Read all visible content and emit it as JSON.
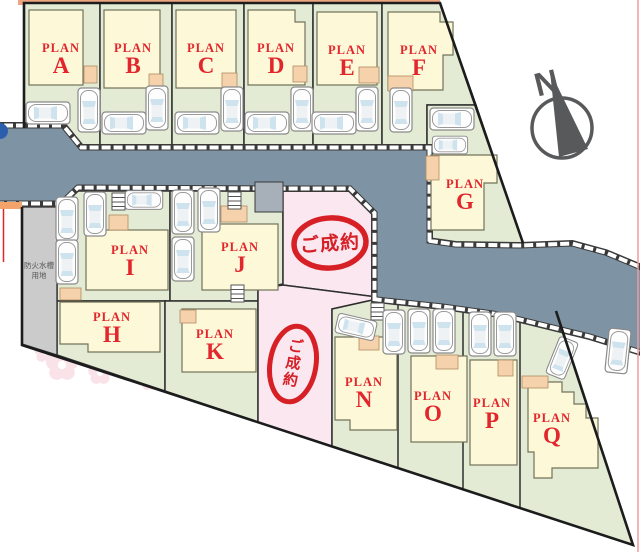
{
  "plans": {
    "a": {
      "prefix": "PLAN",
      "letter": "A"
    },
    "b": {
      "prefix": "PLAN",
      "letter": "B"
    },
    "c": {
      "prefix": "PLAN",
      "letter": "C"
    },
    "d": {
      "prefix": "PLAN",
      "letter": "D"
    },
    "e": {
      "prefix": "PLAN",
      "letter": "E"
    },
    "f": {
      "prefix": "PLAN",
      "letter": "F"
    },
    "g": {
      "prefix": "PLAN",
      "letter": "G"
    },
    "h": {
      "prefix": "PLAN",
      "letter": "H"
    },
    "i": {
      "prefix": "PLAN",
      "letter": "I"
    },
    "j": {
      "prefix": "PLAN",
      "letter": "J"
    },
    "k": {
      "prefix": "PLAN",
      "letter": "K"
    },
    "n": {
      "prefix": "PLAN",
      "letter": "N"
    },
    "o": {
      "prefix": "PLAN",
      "letter": "O"
    },
    "p": {
      "prefix": "PLAN",
      "letter": "P"
    },
    "q": {
      "prefix": "PLAN",
      "letter": "Q"
    }
  },
  "stamps": {
    "sold_text": "ご成約",
    "sold_chars": [
      "ご",
      "成",
      "約"
    ]
  },
  "compass": {
    "north": "N"
  },
  "fire_tank": {
    "line1": "防火水槽",
    "line2": "用地"
  },
  "colors": {
    "road": "#7E93A4",
    "lot_green": "#E3EBD4",
    "house_yellow": "#FCF8D8",
    "lot_pink": "#FAE7F0",
    "stamp_red": "#D71F26",
    "plan_text_red": "#E3262C",
    "porch_tan": "#F5D2AC",
    "fire_tank_gray": "#CBCBCB",
    "compass_gray": "#58595B",
    "boundary_black": "#1c1c1c",
    "neighbor_strip_orange": "#EDA57F",
    "right_border_pink": "#EE9C9C"
  }
}
